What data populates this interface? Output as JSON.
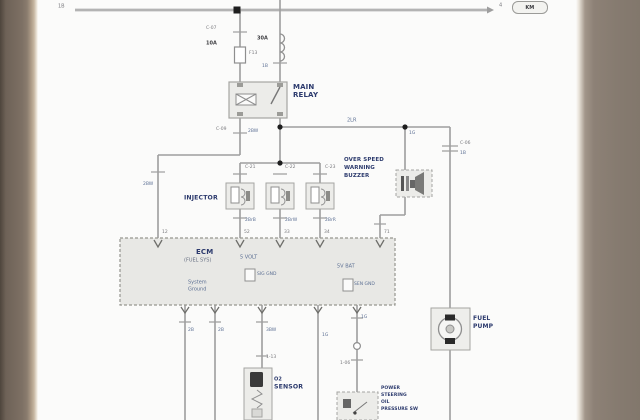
{
  "page_ref": {
    "left_bus_code": "1B",
    "arrow_note": "4",
    "box_label": "KM"
  },
  "supply": {
    "fuse_conn": "C-07",
    "fuse_amp": "10A",
    "fuse_id": "F13",
    "link_amp": "30A",
    "link_code": "1B",
    "relay_line1": "MAIN",
    "relay_line2": "RELAY",
    "pin_a_conn": "C-09",
    "pin_a_code": "2BW",
    "ecm_feed_code": "2BW",
    "feed_code": "2LR"
  },
  "injectors": {
    "label": "INJECTOR",
    "units": [
      {
        "conn": "C-21",
        "code": "2BrB",
        "pin": "52"
      },
      {
        "conn": "C-22",
        "code": "2BrW",
        "pin": "33"
      },
      {
        "conn": "C-23",
        "code": "2BrR",
        "pin": "34"
      }
    ]
  },
  "buzzer": {
    "line1": "OVER SPEED",
    "line2": "WARNING",
    "line3": "BUZZER",
    "code": "1G",
    "pin": "71"
  },
  "pump": {
    "conn": "C-06",
    "code": "1B",
    "line1": "FUEL",
    "line2": "PUMP"
  },
  "ecm": {
    "title": "ECM",
    "subtitle": "(FUEL SYS)",
    "gnd_line1": "System",
    "gnd_line2": "Ground",
    "ref_5v": "5 VOLT",
    "sig_gnd": "SIG GND",
    "ref_bat": "5V BAT",
    "sen_gnd": "SEN GND",
    "pin_left": "12"
  },
  "bottom": {
    "code1": "2B",
    "code2": "2B",
    "code3": "3BW",
    "code4": "1G",
    "code5": "1G",
    "ps_conn": "1-06",
    "sensor_conn": "1-13",
    "sensor_pre": "O2",
    "sensor_label": "SENSOR",
    "ps_line1": "POWER",
    "ps_line2": "STEERING",
    "ps_line3": "OIL",
    "ps_line4": "PRESSURE SW"
  }
}
